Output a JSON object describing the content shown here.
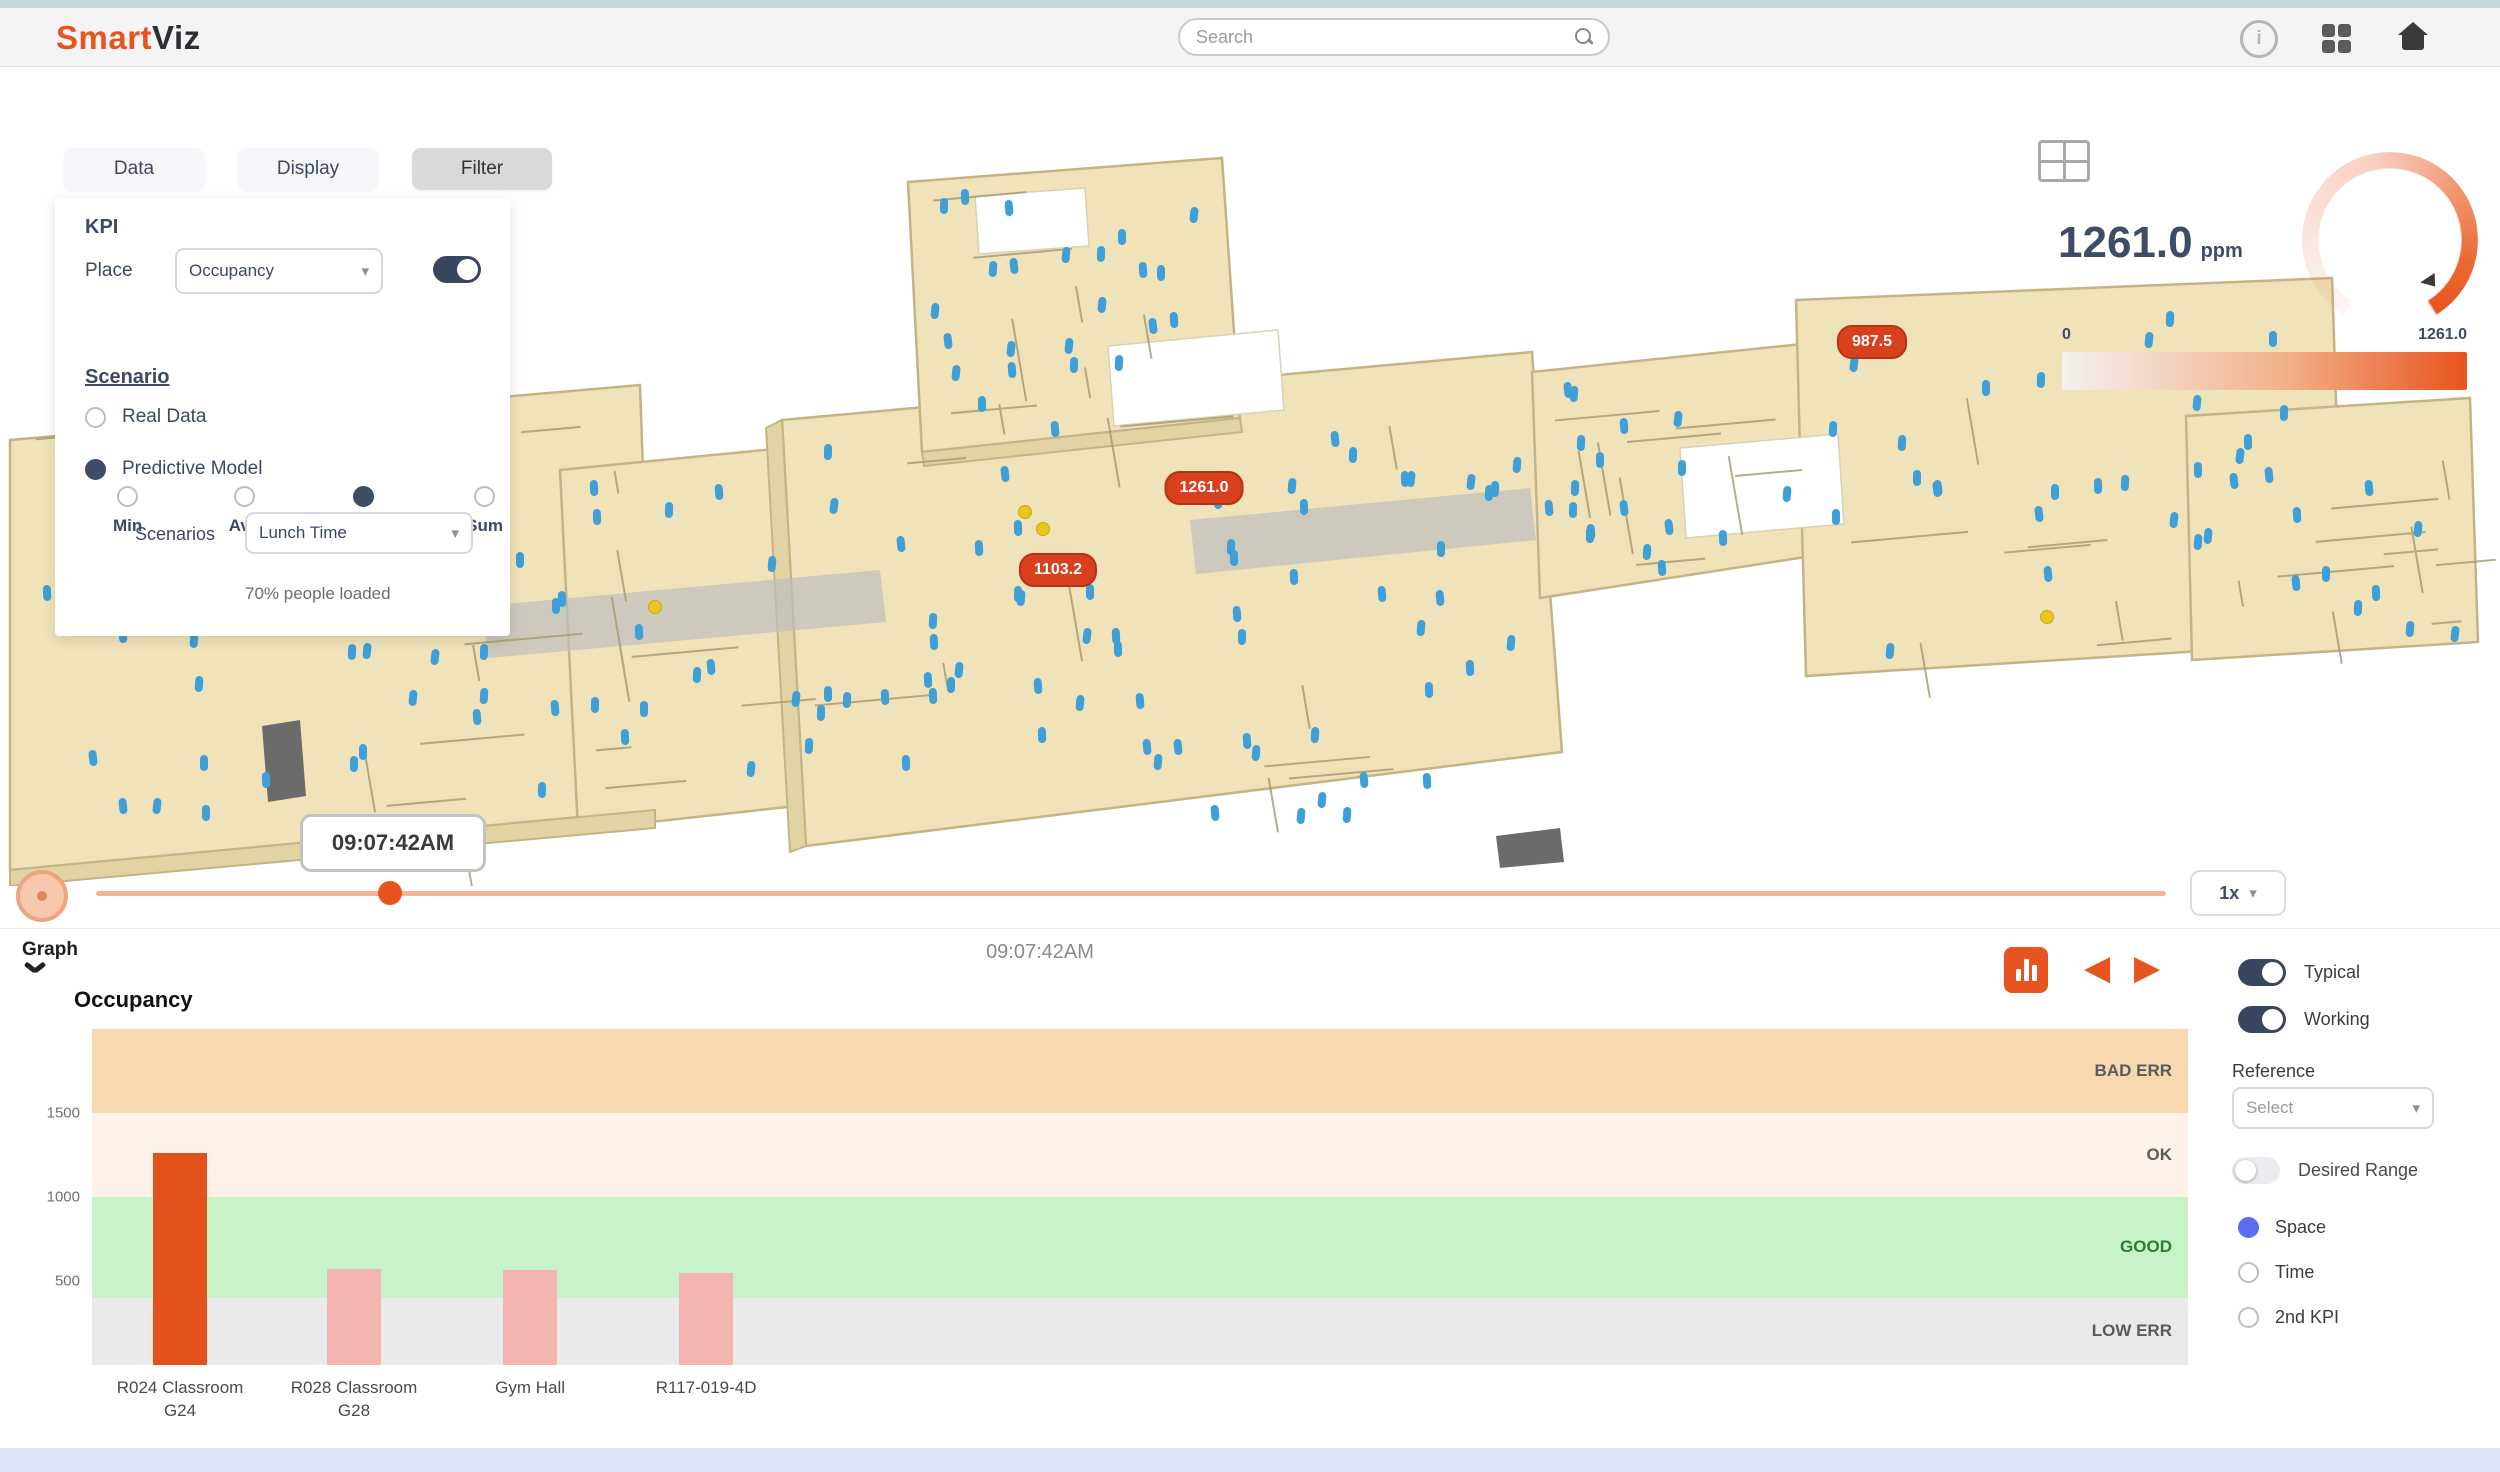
{
  "topbar": {
    "brand": {
      "part1": "Smart",
      "part2": "Viz"
    },
    "search_placeholder": "Search"
  },
  "filter_panel": {
    "tabs": [
      {
        "label": "Data",
        "active": false
      },
      {
        "label": "Display",
        "active": false
      },
      {
        "label": "Filter",
        "active": true
      }
    ],
    "kpi_heading": "KPI",
    "place_label": "Place",
    "place_value": "Occupancy",
    "kpi_toggle_on": true,
    "aggregations": [
      {
        "label": "Min",
        "selected": false
      },
      {
        "label": "Avg",
        "selected": false
      },
      {
        "label": "Max",
        "selected": true
      },
      {
        "label": "Sum",
        "selected": false
      }
    ],
    "scenario_heading": "Scenario",
    "scenario_options": [
      {
        "label": "Real Data",
        "selected": false
      },
      {
        "label": "Predictive Model",
        "selected": true
      }
    ],
    "scenarios_label": "Scenarios",
    "scenarios_value": "Lunch Time",
    "load_note": "70% people loaded"
  },
  "kpi_widget": {
    "value": "1261.0",
    "unit": "ppm",
    "scale_min": "0",
    "scale_max": "1261.0",
    "accent_color": "#e8541f"
  },
  "map": {
    "floor_color": "#f0e3ba",
    "person_color": "#3f9fd8",
    "badges": [
      {
        "value": "1261.0",
        "x": 1204,
        "y": 488
      },
      {
        "value": "1103.2",
        "x": 1058,
        "y": 570
      },
      {
        "value": "987.5",
        "x": 1872,
        "y": 342
      }
    ]
  },
  "timeline": {
    "tooltip": "09:07:42AM",
    "speed": "1x",
    "progress_pct": 14.2
  },
  "graph": {
    "section_label": "Graph",
    "timestamp": "09:07:42AM",
    "title": "Occupancy",
    "toggles": [
      {
        "label": "Typical",
        "on": true
      },
      {
        "label": "Working",
        "on": true
      }
    ],
    "reference_label": "Reference",
    "reference_value": "Select",
    "desired_range": {
      "label": "Desired Range",
      "on": false
    },
    "compare_options": [
      {
        "label": "Space",
        "selected": true
      },
      {
        "label": "Time",
        "selected": false
      },
      {
        "label": "2nd KPI",
        "selected": false
      }
    ]
  },
  "chart_data": {
    "type": "bar",
    "title": "Occupancy",
    "categories": [
      [
        "R024 Classroom",
        "G24"
      ],
      [
        "R028 Classroom",
        "G28"
      ],
      [
        "Gym Hall"
      ],
      [
        "R117-019-4D"
      ]
    ],
    "values": [
      1261,
      570,
      565,
      545
    ],
    "bar_colors": [
      "#e2521d",
      "#f2b5b0",
      "#f2b5b0",
      "#f2b5b0"
    ],
    "ylim": [
      0,
      2000
    ],
    "yticks": [
      1500,
      1000,
      500
    ],
    "bands": [
      {
        "label": "BAD ERR",
        "from": 1500,
        "to": 2000,
        "color": "#f8d8b0",
        "label_color": "#5a5a5a"
      },
      {
        "label": "OK",
        "from": 1000,
        "to": 1500,
        "color": "#fdf1ea",
        "label_color": "#5a5a5a"
      },
      {
        "label": "GOOD",
        "from": 400,
        "to": 1000,
        "color": "#c8f2c8",
        "label_color": "#2e7d32"
      },
      {
        "label": "LOW ERR",
        "from": 0,
        "to": 400,
        "color": "#eaeaea",
        "label_color": "#5a5a5a"
      }
    ],
    "xlabel": "",
    "ylabel": "",
    "grid": false,
    "legend_position": "right-inside"
  }
}
